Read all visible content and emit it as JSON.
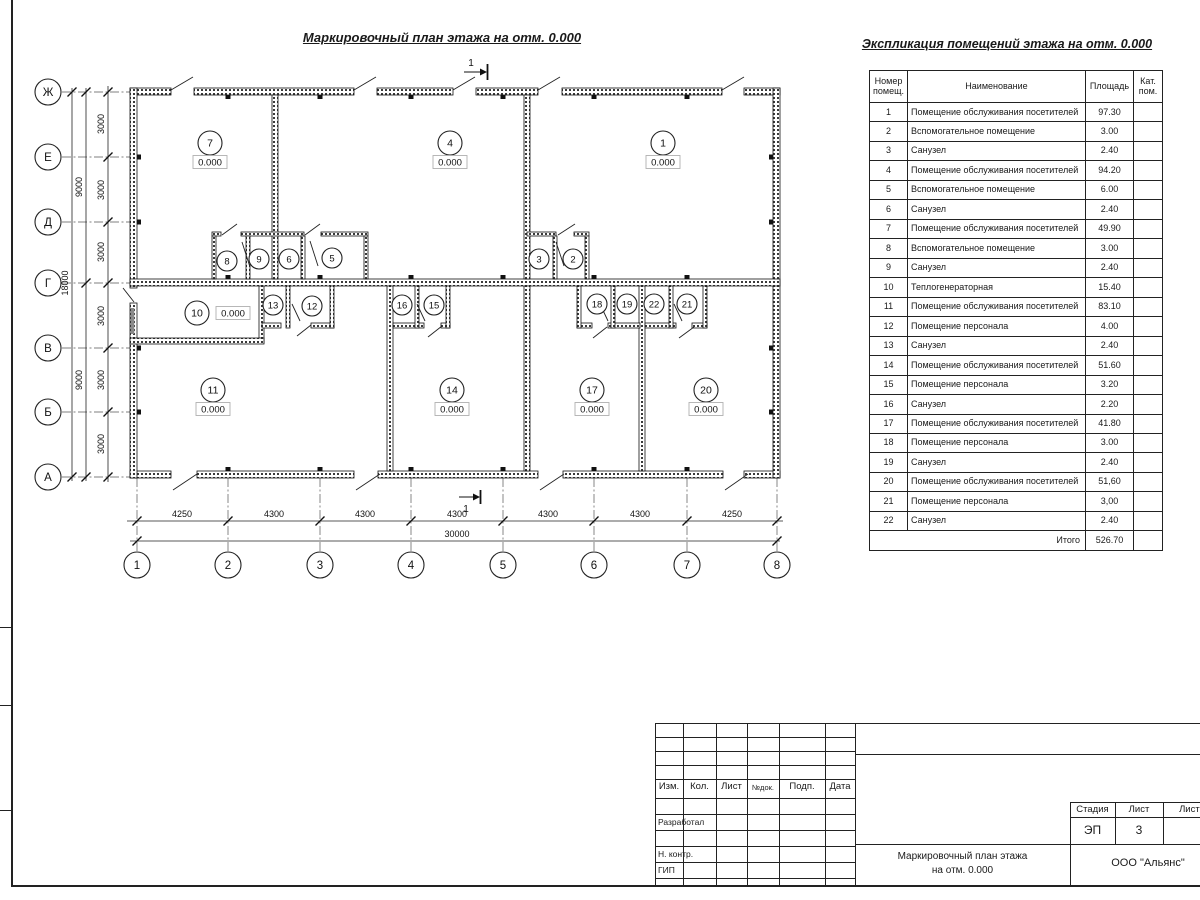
{
  "sheet": {
    "plan_title": "Маркировочный план этажа на отм. 0.000",
    "table_title": "Экспликация помещений этажа на отм. 0.000"
  },
  "plan": {
    "elevation": "0.000",
    "section_label": "1",
    "axis_rows": [
      {
        "label": "Ж",
        "y": 92
      },
      {
        "label": "Е",
        "y": 157
      },
      {
        "label": "Д",
        "y": 222
      },
      {
        "label": "Г",
        "y": 283
      },
      {
        "label": "В",
        "y": 348
      },
      {
        "label": "Б",
        "y": 412
      },
      {
        "label": "А",
        "y": 477
      }
    ],
    "axis_cols": [
      {
        "label": "1",
        "x": 137
      },
      {
        "label": "2",
        "x": 228
      },
      {
        "label": "3",
        "x": 320
      },
      {
        "label": "4",
        "x": 411
      },
      {
        "label": "5",
        "x": 503
      },
      {
        "label": "6",
        "x": 594
      },
      {
        "label": "7",
        "x": 687
      },
      {
        "label": "8",
        "x": 777
      }
    ],
    "dims_bottom": [
      {
        "label": "4250",
        "x": 182
      },
      {
        "label": "4300",
        "x": 274
      },
      {
        "label": "4300",
        "x": 365
      },
      {
        "label": "4300",
        "x": 457
      },
      {
        "label": "4300",
        "x": 548
      },
      {
        "label": "4300",
        "x": 640
      },
      {
        "label": "4250",
        "x": 732
      }
    ],
    "dim_total_bottom": "30000",
    "dims_left": [
      {
        "label": "3000",
        "y": 124
      },
      {
        "label": "3000",
        "y": 190
      },
      {
        "label": "3000",
        "y": 252
      },
      {
        "label": "3000",
        "y": 316
      },
      {
        "label": "3000",
        "y": 380
      },
      {
        "label": "3000",
        "y": 444
      }
    ],
    "dims_left_mid": [
      {
        "label": "9000",
        "y": 187
      },
      {
        "label": "9000",
        "y": 380
      }
    ],
    "dim_total_left": "18000",
    "rooms_large": [
      {
        "num": "7",
        "x": 210,
        "y": 143
      },
      {
        "num": "4",
        "x": 450,
        "y": 143
      },
      {
        "num": "1",
        "x": 663,
        "y": 143
      },
      {
        "num": "11",
        "x": 213,
        "y": 390
      },
      {
        "num": "14",
        "x": 452,
        "y": 390
      },
      {
        "num": "17",
        "x": 592,
        "y": 390
      },
      {
        "num": "20",
        "x": 706,
        "y": 390
      }
    ],
    "room10": {
      "num": "10",
      "x": 197,
      "y": 313,
      "elev_x": 233
    },
    "rooms_small": [
      {
        "num": "8",
        "x": 227,
        "y": 261
      },
      {
        "num": "9",
        "x": 259,
        "y": 259
      },
      {
        "num": "6",
        "x": 289,
        "y": 259
      },
      {
        "num": "5",
        "x": 332,
        "y": 258
      },
      {
        "num": "3",
        "x": 539,
        "y": 259
      },
      {
        "num": "2",
        "x": 573,
        "y": 259
      },
      {
        "num": "13",
        "x": 273,
        "y": 305
      },
      {
        "num": "12",
        "x": 312,
        "y": 306
      },
      {
        "num": "16",
        "x": 402,
        "y": 305
      },
      {
        "num": "15",
        "x": 434,
        "y": 305
      },
      {
        "num": "18",
        "x": 597,
        "y": 304
      },
      {
        "num": "19",
        "x": 627,
        "y": 304
      },
      {
        "num": "22",
        "x": 654,
        "y": 304
      },
      {
        "num": "21",
        "x": 687,
        "y": 304
      }
    ]
  },
  "schedule": {
    "headers": [
      "Номер помещ.",
      "Наименование",
      "Площадь",
      "Кат. пом."
    ],
    "rows": [
      {
        "num": "1",
        "name": "Помещение обслуживания посетителей",
        "area": "97.30"
      },
      {
        "num": "2",
        "name": "Вспомогательное помещение",
        "area": "3.00"
      },
      {
        "num": "3",
        "name": "Санузел",
        "area": "2.40"
      },
      {
        "num": "4",
        "name": "Помещение обслуживания посетителей",
        "area": "94.20"
      },
      {
        "num": "5",
        "name": "Вспомогательное помещение",
        "area": "6.00"
      },
      {
        "num": "6",
        "name": "Санузел",
        "area": "2.40"
      },
      {
        "num": "7",
        "name": "Помещение обслуживания посетителей",
        "area": "49.90"
      },
      {
        "num": "8",
        "name": "Вспомогательное помещение",
        "area": "3.00"
      },
      {
        "num": "9",
        "name": "Санузел",
        "area": "2.40"
      },
      {
        "num": "10",
        "name": "Теплогенераторная",
        "area": "15.40"
      },
      {
        "num": "11",
        "name": "Помещение обслуживания посетителей",
        "area": "83.10"
      },
      {
        "num": "12",
        "name": "Помещение персонала",
        "area": "4.00"
      },
      {
        "num": "13",
        "name": "Санузел",
        "area": "2.40"
      },
      {
        "num": "14",
        "name": "Помещение обслуживания посетителей",
        "area": "51.60"
      },
      {
        "num": "15",
        "name": "Помещение персонала",
        "area": "3.20"
      },
      {
        "num": "16",
        "name": "Санузел",
        "area": "2.20"
      },
      {
        "num": "17",
        "name": "Помещение обслуживания посетителей",
        "area": "41.80"
      },
      {
        "num": "18",
        "name": "Помещение персонала",
        "area": "3.00"
      },
      {
        "num": "19",
        "name": "Санузел",
        "area": "2.40"
      },
      {
        "num": "20",
        "name": "Помещение обслуживания посетителей",
        "area": "51,60"
      },
      {
        "num": "21",
        "name": "Помещение персонала",
        "area": "3,00"
      },
      {
        "num": "22",
        "name": "Санузел",
        "area": "2.40"
      }
    ],
    "total_label": "Итого",
    "total_value": "526.70"
  },
  "titleblock": {
    "revision_headers": [
      "Изм.",
      "Кол.",
      "Лист",
      "№док.",
      "Подп.",
      "Дата"
    ],
    "roles": [
      "Разработал",
      "Н. контр.",
      "ГИП"
    ],
    "stage_label": "Стадия",
    "sheet_label": "Лист",
    "sheets_label": "Листов",
    "stage_value": "ЭП",
    "sheet_value": "3",
    "doc_title_line1": "Маркировочный план этажа",
    "doc_title_line2": "на отм. 0.000",
    "company": "ООО \"Альянс\""
  }
}
